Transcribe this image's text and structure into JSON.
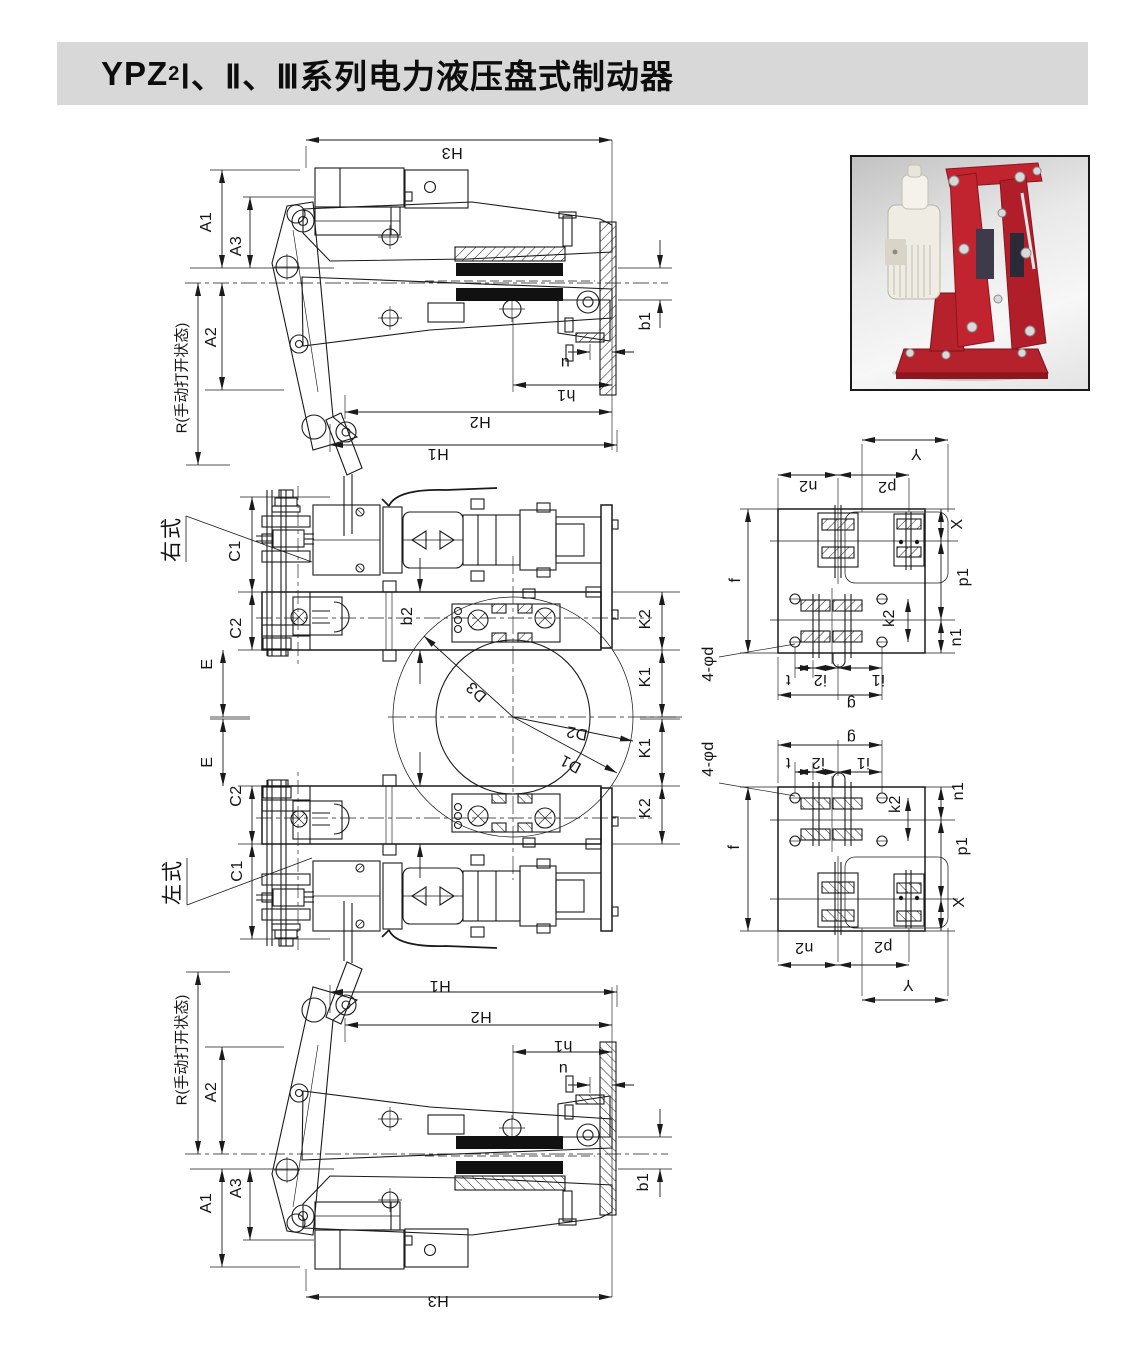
{
  "page": {
    "title": {
      "prefix": "YPZ",
      "subscript": "2",
      "rest": "Ⅰ、Ⅱ、Ⅲ系列电力液压盘式制动器"
    },
    "title_bar_color": "#d8d8d8"
  },
  "photo": {
    "description_colors": {
      "brake_body": "#bb2129",
      "thruster": "#efece3",
      "frame": "#1a1a1a"
    }
  },
  "drawing": {
    "line_color": "#1a1a1a",
    "labels": [
      {
        "t": "H3",
        "x": 452,
        "y": 152,
        "r": 180
      },
      {
        "t": "A1",
        "x": 207,
        "y": 222,
        "r": -90
      },
      {
        "t": "A3",
        "x": 237,
        "y": 246,
        "r": -90
      },
      {
        "t": "A2",
        "x": 212,
        "y": 337,
        "r": -90
      },
      {
        "t": "R(手动打开状态)",
        "x": 182,
        "y": 378,
        "r": -90,
        "c": "r"
      },
      {
        "t": "b1",
        "x": 646,
        "y": 321,
        "r": -90
      },
      {
        "t": "u",
        "x": 565,
        "y": 362,
        "r": 180
      },
      {
        "t": "h1",
        "x": 566,
        "y": 394,
        "r": 180
      },
      {
        "t": "H2",
        "x": 480,
        "y": 421,
        "r": 180
      },
      {
        "t": "H1",
        "x": 438,
        "y": 453,
        "r": 180
      },
      {
        "t": "右式",
        "x": 172,
        "y": 539,
        "r": -90,
        "c": "cn"
      },
      {
        "t": "C1",
        "x": 236,
        "y": 551,
        "r": -90
      },
      {
        "t": "C2",
        "x": 237,
        "y": 628,
        "r": -90
      },
      {
        "t": "E",
        "x": 208,
        "y": 664,
        "r": -90
      },
      {
        "t": "b2",
        "x": 408,
        "y": 616,
        "r": -90
      },
      {
        "t": "K2",
        "x": 646,
        "y": 619,
        "r": -90
      },
      {
        "t": "K1",
        "x": 646,
        "y": 677,
        "r": -90
      },
      {
        "t": "D3",
        "x": 477,
        "y": 691,
        "r": 222
      },
      {
        "t": "D2",
        "x": 577,
        "y": 732,
        "r": 191
      },
      {
        "t": "D1",
        "x": 571,
        "y": 763,
        "r": 208
      },
      {
        "t": "K1",
        "x": 646,
        "y": 748,
        "r": -90
      },
      {
        "t": "K2",
        "x": 646,
        "y": 808,
        "r": -90
      },
      {
        "t": "E",
        "x": 208,
        "y": 762,
        "r": -90
      },
      {
        "t": "C2",
        "x": 237,
        "y": 796,
        "r": -90
      },
      {
        "t": "C1",
        "x": 238,
        "y": 871,
        "r": -90
      },
      {
        "t": "左式",
        "x": 173,
        "y": 882,
        "r": -90,
        "c": "cn"
      },
      {
        "t": "Y",
        "x": 916,
        "y": 453,
        "r": 180
      },
      {
        "t": "n2",
        "x": 808,
        "y": 485,
        "r": 180
      },
      {
        "t": "p2",
        "x": 887,
        "y": 486,
        "r": 180
      },
      {
        "t": "X",
        "x": 958,
        "y": 524,
        "r": -90
      },
      {
        "t": "f",
        "x": 736,
        "y": 580,
        "r": -90
      },
      {
        "t": "p1",
        "x": 964,
        "y": 577,
        "r": -90
      },
      {
        "t": "k2",
        "x": 890,
        "y": 618,
        "r": -90
      },
      {
        "t": "n1",
        "x": 957,
        "y": 637,
        "r": -90
      },
      {
        "t": "4-φd",
        "x": 709,
        "y": 664,
        "r": -90
      },
      {
        "t": "t",
        "x": 788,
        "y": 679,
        "r": 180
      },
      {
        "t": "i2",
        "x": 820,
        "y": 679,
        "r": 180
      },
      {
        "t": "i1",
        "x": 878,
        "y": 679,
        "r": 180
      },
      {
        "t": "g",
        "x": 851,
        "y": 703,
        "r": 180
      },
      {
        "t": "g",
        "x": 851,
        "y": 737,
        "r": 180
      },
      {
        "t": "4-φd",
        "x": 709,
        "y": 759,
        "r": -90
      },
      {
        "t": "t",
        "x": 788,
        "y": 762,
        "r": 180
      },
      {
        "t": "i2",
        "x": 818,
        "y": 762,
        "r": 180
      },
      {
        "t": "i1",
        "x": 863,
        "y": 762,
        "r": 180
      },
      {
        "t": "n1",
        "x": 959,
        "y": 791,
        "r": -90
      },
      {
        "t": "k2",
        "x": 896,
        "y": 804,
        "r": -90
      },
      {
        "t": "f",
        "x": 735,
        "y": 847,
        "r": -90
      },
      {
        "t": "p1",
        "x": 963,
        "y": 846,
        "r": -90
      },
      {
        "t": "X",
        "x": 960,
        "y": 902,
        "r": -90
      },
      {
        "t": "n2",
        "x": 804,
        "y": 947,
        "r": 180
      },
      {
        "t": "p2",
        "x": 883,
        "y": 946,
        "r": 180
      },
      {
        "t": "Y",
        "x": 908,
        "y": 984,
        "r": 180
      },
      {
        "t": "H1",
        "x": 440,
        "y": 985,
        "r": 180
      },
      {
        "t": "H2",
        "x": 481,
        "y": 1016,
        "r": 180
      },
      {
        "t": "h1",
        "x": 563,
        "y": 1045,
        "r": 180
      },
      {
        "t": "u",
        "x": 563,
        "y": 1068,
        "r": 180
      },
      {
        "t": "R(手动打开状态)",
        "x": 182,
        "y": 1050,
        "r": -90,
        "c": "r"
      },
      {
        "t": "A2",
        "x": 212,
        "y": 1092,
        "r": -90
      },
      {
        "t": "b1",
        "x": 644,
        "y": 1182,
        "r": -90
      },
      {
        "t": "A3",
        "x": 237,
        "y": 1188,
        "r": -90
      },
      {
        "t": "A1",
        "x": 207,
        "y": 1203,
        "r": -90
      },
      {
        "t": "H3",
        "x": 438,
        "y": 1300,
        "r": 180
      }
    ]
  }
}
